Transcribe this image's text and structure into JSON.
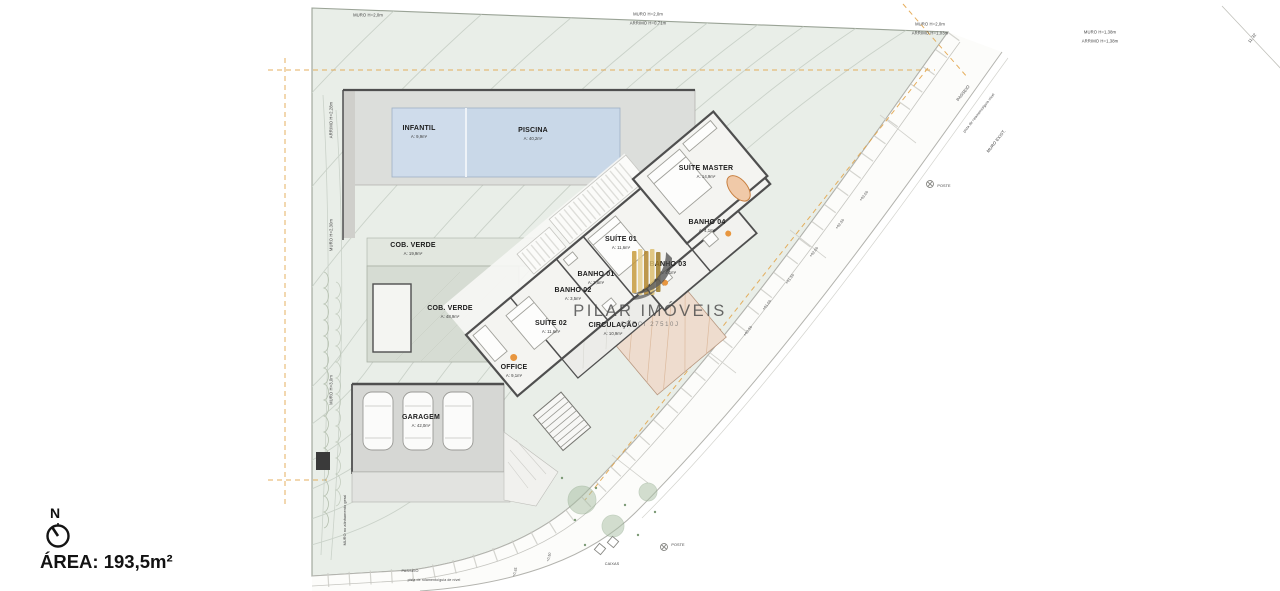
{
  "watermark": {
    "name": "PILAR IMÓVEIS",
    "creci": "CRECI 27510J"
  },
  "compass": {
    "north": "N"
  },
  "area": {
    "label": "ÁREA: 193,5m²"
  },
  "colors": {
    "lot_green": "#e9eee8",
    "contour": "#c7cfc6",
    "pool_blue": "#c9d8e8",
    "deck_gray": "#dcdedb",
    "wall_dark": "#4f4f4f",
    "setback_orange": "#e2a244",
    "terrace_pink": "#eedcce",
    "logo_gold": "#c89d3f"
  },
  "rooms": [
    {
      "label": "INFANTIL",
      "area": "A: 9,9m²",
      "x": 419,
      "y": 132
    },
    {
      "label": "PISCINA",
      "area": "A: 40,2m²",
      "x": 533,
      "y": 134
    },
    {
      "label": "SUÍTE MASTER",
      "area": "A: 14,9m²",
      "x": 706,
      "y": 172
    },
    {
      "label": "BANHO 04",
      "area": "A: 4,1m²",
      "x": 707,
      "y": 226
    },
    {
      "label": "SUÍTE 01",
      "area": "A: 11,6m²",
      "x": 621,
      "y": 243
    },
    {
      "label": "BANHO 03",
      "area": "A: 4,1m²",
      "x": 668,
      "y": 268
    },
    {
      "label": "BANHO 01",
      "area": "A: 3,5m²",
      "x": 596,
      "y": 278
    },
    {
      "label": "BANHO 02",
      "area": "A: 3,5m²",
      "x": 573,
      "y": 294
    },
    {
      "label": "SUÍTE 02",
      "area": "A: 11,6m²",
      "x": 551,
      "y": 327
    },
    {
      "label": "CIRCULAÇÃO",
      "area": "A: 10,9m²",
      "x": 613,
      "y": 329
    },
    {
      "label": "OFFICE",
      "area": "A: 9,1m²",
      "x": 514,
      "y": 371
    },
    {
      "label": "COB. VERDE",
      "area": "A: 19,9m²",
      "x": 413,
      "y": 249
    },
    {
      "label": "COB. VERDE",
      "area": "A: 48,9m²",
      "x": 450,
      "y": 312
    },
    {
      "label": "GARAGEM",
      "area": "A: 42,0m²",
      "x": 421,
      "y": 421
    }
  ],
  "annotations": [
    {
      "text": "MURO H=2,0m",
      "x": 368,
      "y": 15
    },
    {
      "text": "MURO H=2,0m",
      "x": 648,
      "y": 14
    },
    {
      "text": "ARRIMO H=0,71m",
      "x": 648,
      "y": 23
    },
    {
      "text": "MURO H=2,0m",
      "x": 930,
      "y": 24
    },
    {
      "text": "ARRIMO H=1,03m",
      "x": 930,
      "y": 33
    },
    {
      "text": "MURO H=1,38m",
      "x": 1100,
      "y": 32
    },
    {
      "text": "ARRIMO H=1,38m",
      "x": 1100,
      "y": 41
    },
    {
      "text": "ARRIMO H=2,28m",
      "x": 331,
      "y": 120,
      "rot": -90
    },
    {
      "text": "MURO H=2,30m",
      "x": 331,
      "y": 235,
      "rot": -90
    },
    {
      "text": "MURO H=3,0m",
      "x": 331,
      "y": 390,
      "rot": -90
    },
    {
      "text": "MURO no alinhamento geral",
      "x": 345,
      "y": 520,
      "rot": -90,
      "size": 3.8
    },
    {
      "text": "PASSEIO",
      "x": 963,
      "y": 93,
      "rot": -52
    },
    {
      "text": "pista de rolamento/guia nível",
      "x": 979,
      "y": 113,
      "rot": -52,
      "size": 3.6
    },
    {
      "text": "MURO EXIST.",
      "x": 996,
      "y": 141,
      "rot": -52
    },
    {
      "text": "POSTE",
      "x": 944,
      "y": 186,
      "size": 3.8
    },
    {
      "text": "11,32",
      "x": 1252,
      "y": 38,
      "rot": -52
    },
    {
      "text": "+03,00",
      "x": 864,
      "y": 196,
      "rot": -52,
      "size": 3.6
    },
    {
      "text": "+02,50",
      "x": 840,
      "y": 224,
      "rot": -52,
      "size": 3.6
    },
    {
      "text": "+02,00",
      "x": 814,
      "y": 252,
      "rot": -52,
      "size": 3.6
    },
    {
      "text": "+01,50",
      "x": 790,
      "y": 279,
      "rot": -52,
      "size": 3.6
    },
    {
      "text": "+01,00",
      "x": 767,
      "y": 305,
      "rot": -52,
      "size": 3.6
    },
    {
      "text": "+00,50",
      "x": 748,
      "y": 331,
      "rot": -52,
      "size": 3.6
    },
    {
      "text": "PASSEIO",
      "x": 410,
      "y": 571,
      "size": 3.8
    },
    {
      "text": "pista de rolamento/guia de nível",
      "x": 434,
      "y": 580,
      "size": 3.5
    },
    {
      "text": "CAIXAS",
      "x": 612,
      "y": 564,
      "size": 3.8
    },
    {
      "text": "POSTE",
      "x": 678,
      "y": 545,
      "size": 3.8
    },
    {
      "text": "+0,50",
      "x": 549,
      "y": 557,
      "rot": -75,
      "size": 3.5
    },
    {
      "text": "+0,35",
      "x": 515,
      "y": 572,
      "rot": -75,
      "size": 3.5
    }
  ]
}
